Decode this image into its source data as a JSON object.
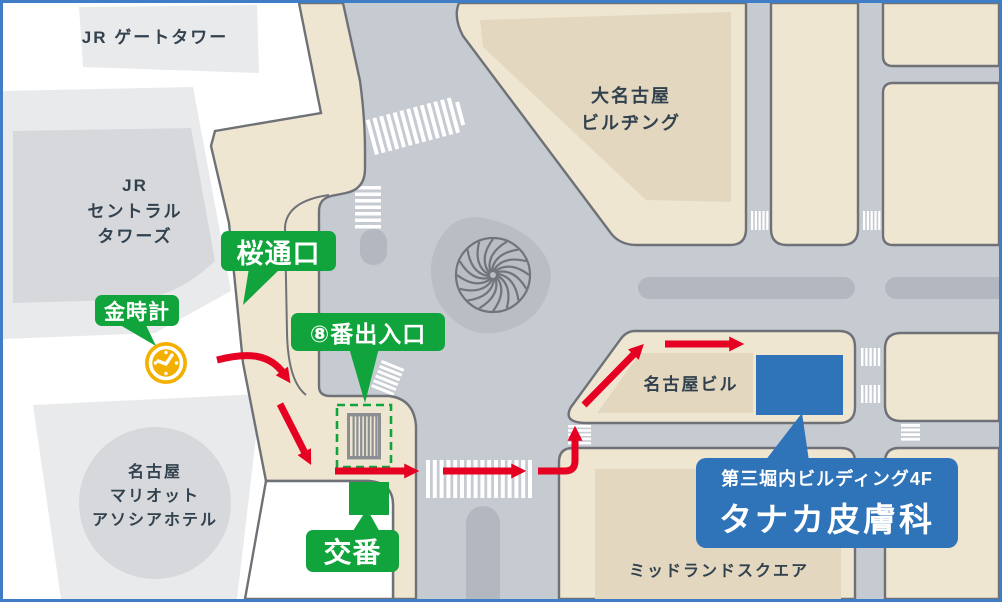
{
  "buildings": {
    "jr_gate_tower": {
      "label": "JR ゲートタワー"
    },
    "jr_central_towers": {
      "line1": "JR",
      "line2": "セントラル",
      "line3": "タワーズ"
    },
    "dai_nagoya": {
      "line1": "大名古屋",
      "line2": "ビルヂング"
    },
    "nagoya_biru": {
      "label": "名古屋ビル"
    },
    "midland_square": {
      "label": "ミッドランドスクエア"
    },
    "marriott_hotel": {
      "line1": "名古屋",
      "line2": "マリオット",
      "line3": "アソシアホテル"
    }
  },
  "markers": {
    "sakura_dori_exit": {
      "label": "桜通口"
    },
    "gold_clock": {
      "label": "金時計"
    },
    "exit_8": {
      "label": "⑧番出入口"
    },
    "koban": {
      "label": "交番"
    }
  },
  "destination": {
    "building_floor": "第三堀内ビルディング4F",
    "clinic_name": "タナカ皮膚科"
  },
  "icons": {
    "gold_clock": "clock-icon",
    "exit_stairs": "stairs-icon",
    "station_rotary": "spiral-monument-icon",
    "police_box": "green-square-marker",
    "route": "red-arrow-route",
    "crosswalk": "zebra-stripes"
  },
  "colors": {
    "road": "#c6cad1",
    "median": "#b3b7bf",
    "block_beige": "#efe6d2",
    "block_beige_inner": "#e3d8bf",
    "block_gray": "#e9eaec",
    "block_gray_inner": "#d6d8dc",
    "outline": "#6e7277",
    "marker_green": "#12a43c",
    "route_red": "#e60021",
    "destination_blue": "#2f73b9",
    "clock_gold": "#f4b000",
    "label_text": "#32414e",
    "frame_border": "#3f7ec6"
  }
}
